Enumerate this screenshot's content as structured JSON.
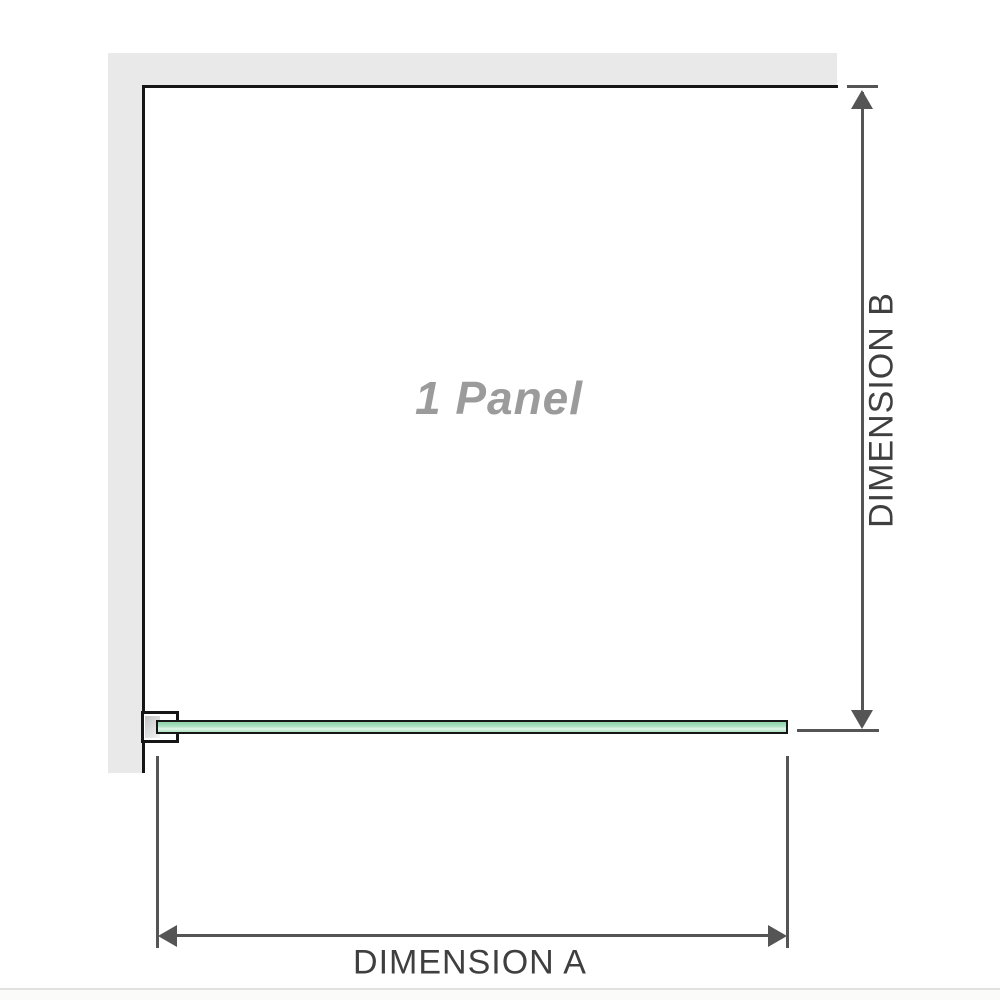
{
  "diagram": {
    "panel_label": "1 Panel",
    "dimension_a": {
      "label": "DIMENSION A"
    },
    "dimension_b": {
      "label": "DIMENSION B"
    }
  },
  "colors": {
    "background": "#ffffff",
    "wall_fill": "#e9e9e9",
    "wall_edge_line": "#161616",
    "dimension_line": "#555555",
    "dimension_text": "#3f3f3f",
    "panel_label_text": "#9b9b9b",
    "glass_fill_light": "#dff4e8",
    "glass_fill_dark": "#8fd2a8",
    "glass_border": "#161616",
    "bracket_pad_fill": "#c3c3c3",
    "bottom_divider": "#e2e2df"
  }
}
